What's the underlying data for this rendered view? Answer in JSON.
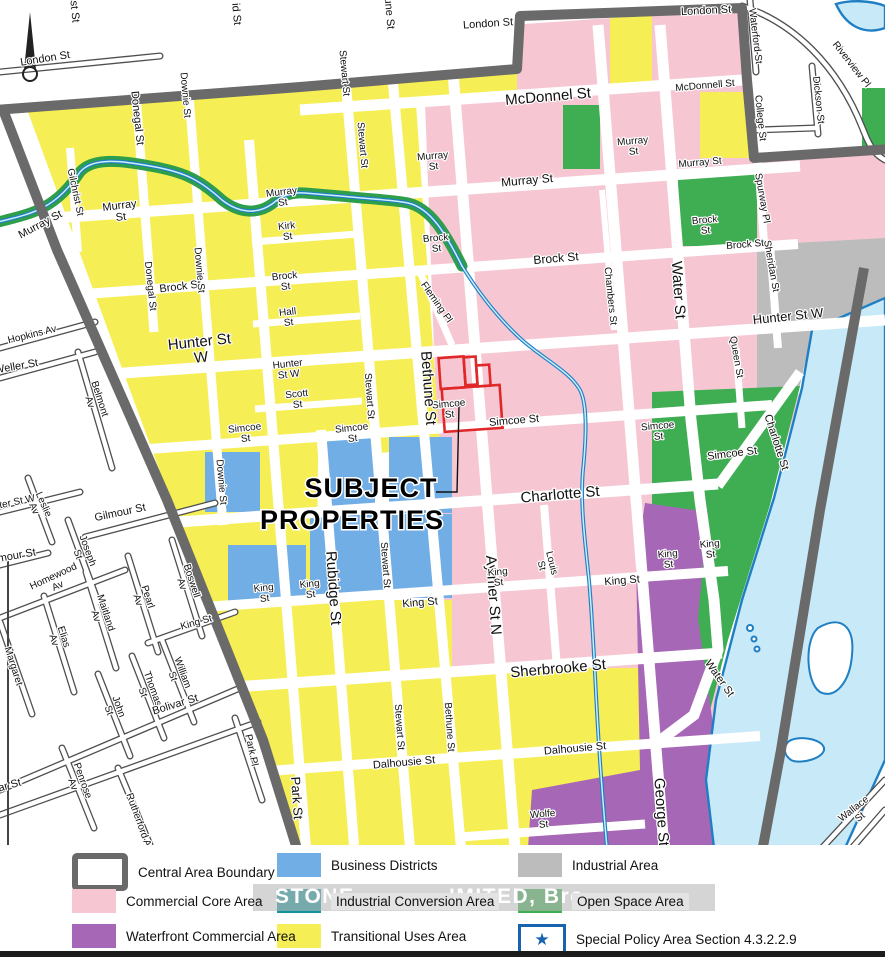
{
  "colors": {
    "pink": "#f6c7d3",
    "purple": "#a667b6",
    "blue": "#72aee6",
    "teal": "#15939a",
    "yellow": "#f6ee55",
    "gray": "#bcbcbc",
    "green": "#3fae53",
    "boundary": "#6a6a6a",
    "river": "#c8e9f7",
    "shore": "#1f7fc4",
    "red": "#e02828",
    "star": "#1763ae",
    "creek_buffer": "#2e9e4a"
  },
  "map": {
    "annotation": {
      "line1": "SUBJECT",
      "line2": "PROPERTIES"
    },
    "watermark": {
      "seg1": "STONE",
      "seg2": "IMITED, Bro"
    },
    "labels": [
      {
        "t": "London St",
        "x": 45,
        "y": 58,
        "r": -9,
        "s": 11
      },
      {
        "t": "Gilchrist St",
        "x": 74,
        "y": -4,
        "r": 85,
        "s": 11
      },
      {
        "t": "id St",
        "x": 237,
        "y": 14,
        "r": 85,
        "s": 11
      },
      {
        "t": "Bethune St",
        "x": 389,
        "y": 2,
        "r": 85,
        "s": 11
      },
      {
        "t": "London St",
        "x": 488,
        "y": 23,
        "r": -4,
        "s": 11
      },
      {
        "t": "London St",
        "x": 706,
        "y": 10,
        "r": -3,
        "s": 11
      },
      {
        "t": "Stewart St",
        "x": 345,
        "y": 73,
        "r": 85,
        "s": 10
      },
      {
        "t": "Stewart St",
        "x": 363,
        "y": 145,
        "r": 85,
        "s": 10
      },
      {
        "t": "Donegal St",
        "x": 138,
        "y": 118,
        "r": 84,
        "s": 11
      },
      {
        "t": "Downie St",
        "x": 186,
        "y": 95,
        "r": 85,
        "s": 10
      },
      {
        "t": "McDonnel St",
        "x": 548,
        "y": 96,
        "r": -5,
        "s": 15
      },
      {
        "t": "McDonnell St",
        "x": 705,
        "y": 85,
        "r": -5,
        "s": 10
      },
      {
        "t": "Murray St",
        "x": 40,
        "y": 224,
        "r": -28,
        "s": 11
      },
      {
        "t": "Murray\nSt",
        "x": 120,
        "y": 210,
        "r": -7,
        "s": 11
      },
      {
        "t": "Murray\nSt",
        "x": 282,
        "y": 196,
        "r": -7,
        "s": 10
      },
      {
        "t": "Gilchrist St",
        "x": 76,
        "y": 192,
        "r": 78,
        "s": 10
      },
      {
        "t": "Murray\nSt",
        "x": 433,
        "y": 160,
        "r": -5,
        "s": 10
      },
      {
        "t": "Murray St",
        "x": 527,
        "y": 180,
        "r": -5,
        "s": 12
      },
      {
        "t": "Murray\nSt",
        "x": 633,
        "y": 145,
        "r": -5,
        "s": 10
      },
      {
        "t": "Murray St",
        "x": 700,
        "y": 162,
        "r": -5,
        "s": 10
      },
      {
        "t": "Kirk\nSt",
        "x": 287,
        "y": 230,
        "r": -6,
        "s": 10
      },
      {
        "t": "Brock St",
        "x": 180,
        "y": 286,
        "r": -7,
        "s": 11
      },
      {
        "t": "Brock\nSt",
        "x": 285,
        "y": 280,
        "r": -6,
        "s": 10
      },
      {
        "t": "Brock\nSt",
        "x": 436,
        "y": 242,
        "r": -5,
        "s": 10
      },
      {
        "t": "Brock St",
        "x": 556,
        "y": 258,
        "r": -5,
        "s": 12
      },
      {
        "t": "Brock\nSt",
        "x": 705,
        "y": 224,
        "r": -5,
        "s": 10
      },
      {
        "t": "Brock St",
        "x": 745,
        "y": 244,
        "r": -5,
        "s": 10
      },
      {
        "t": "Chambers St",
        "x": 611,
        "y": 296,
        "r": 84,
        "s": 10
      },
      {
        "t": "Water St",
        "x": 679,
        "y": 290,
        "r": 86,
        "s": 15
      },
      {
        "t": "Sheridan St",
        "x": 772,
        "y": 266,
        "r": 80,
        "s": 10
      },
      {
        "t": "Spurway Pl",
        "x": 763,
        "y": 198,
        "r": 80,
        "s": 10
      },
      {
        "t": "College St",
        "x": 761,
        "y": 118,
        "r": 84,
        "s": 10
      },
      {
        "t": "Dickson St",
        "x": 819,
        "y": 100,
        "r": 84,
        "s": 10
      },
      {
        "t": "Waterford St",
        "x": 756,
        "y": 36,
        "r": 83,
        "s": 10
      },
      {
        "t": "Riverview Pl",
        "x": 852,
        "y": 64,
        "r": 52,
        "s": 10
      },
      {
        "t": "Hopkins Av",
        "x": 32,
        "y": 334,
        "r": -14,
        "s": 10
      },
      {
        "t": "Weller St",
        "x": 16,
        "y": 366,
        "r": -10,
        "s": 11
      },
      {
        "t": "Belmont\nAv",
        "x": 96,
        "y": 400,
        "r": 72,
        "s": 10
      },
      {
        "t": "Hunter St\nW",
        "x": 200,
        "y": 348,
        "r": -6,
        "s": 15
      },
      {
        "t": "Hunter\nSt W",
        "x": 288,
        "y": 368,
        "r": -6,
        "s": 10
      },
      {
        "t": "Hunter St W",
        "x": 788,
        "y": 316,
        "r": -6,
        "s": 13
      },
      {
        "t": "Hall\nSt",
        "x": 288,
        "y": 316,
        "r": -6,
        "s": 10
      },
      {
        "t": "Scott\nSt",
        "x": 297,
        "y": 398,
        "r": -6,
        "s": 10
      },
      {
        "t": "Fleming Pl",
        "x": 437,
        "y": 302,
        "r": 55,
        "s": 10
      },
      {
        "t": "Hunter St W",
        "x": 8,
        "y": 503,
        "r": -12,
        "s": 10
      },
      {
        "t": "Homewood\nAv",
        "x": 55,
        "y": 580,
        "r": -25,
        "s": 10
      },
      {
        "t": "Simcoe\nSt",
        "x": 245,
        "y": 432,
        "r": -6,
        "s": 10
      },
      {
        "t": "Simcoe\nSt",
        "x": 352,
        "y": 432,
        "r": -6,
        "s": 10
      },
      {
        "t": "Simcoe\nSt",
        "x": 449,
        "y": 408,
        "r": -5,
        "s": 10
      },
      {
        "t": "Simcoe St",
        "x": 514,
        "y": 420,
        "r": -5,
        "s": 11
      },
      {
        "t": "Simcoe\nSt",
        "x": 658,
        "y": 430,
        "r": -5,
        "s": 10
      },
      {
        "t": "Simcoe St",
        "x": 732,
        "y": 453,
        "r": -7,
        "s": 11
      },
      {
        "t": "Queen St",
        "x": 737,
        "y": 357,
        "r": 80,
        "s": 10
      },
      {
        "t": "Charlotte St",
        "x": 560,
        "y": 494,
        "r": -5,
        "s": 15
      },
      {
        "t": "Charlotte St",
        "x": 777,
        "y": 442,
        "r": 72,
        "s": 11
      },
      {
        "t": "Bethune St",
        "x": 429,
        "y": 388,
        "r": 86,
        "s": 15
      },
      {
        "t": "Stewart St",
        "x": 370,
        "y": 396,
        "r": 86,
        "s": 10
      },
      {
        "t": "Downie St",
        "x": 222,
        "y": 482,
        "r": 85,
        "s": 10
      },
      {
        "t": "Downie St",
        "x": 200,
        "y": 270,
        "r": 85,
        "s": 10
      },
      {
        "t": "Donegal St",
        "x": 151,
        "y": 286,
        "r": 84,
        "s": 10
      },
      {
        "t": "Leslie\nAv",
        "x": 40,
        "y": 506,
        "r": 66,
        "s": 10
      },
      {
        "t": "Gilmour St",
        "x": 120,
        "y": 512,
        "r": -12,
        "s": 11
      },
      {
        "t": "Gilmour St",
        "x": 10,
        "y": 556,
        "r": -10,
        "s": 11
      },
      {
        "t": "Joseph\nSt",
        "x": 84,
        "y": 552,
        "r": 70,
        "s": 10
      },
      {
        "t": "Boswell\nAv",
        "x": 188,
        "y": 582,
        "r": 72,
        "s": 10
      },
      {
        "t": "Pearl\nAv",
        "x": 144,
        "y": 598,
        "r": 72,
        "s": 10
      },
      {
        "t": "Maitland\nAv",
        "x": 102,
        "y": 614,
        "r": 72,
        "s": 10
      },
      {
        "t": "Elias\nAv",
        "x": 60,
        "y": 638,
        "r": 72,
        "s": 10
      },
      {
        "t": "Margaret",
        "x": 14,
        "y": 666,
        "r": 72,
        "s": 10
      },
      {
        "t": "Rubidge St",
        "x": 334,
        "y": 588,
        "r": 86,
        "s": 15
      },
      {
        "t": "Stewart St",
        "x": 386,
        "y": 565,
        "r": 86,
        "s": 10
      },
      {
        "t": "Aylmer St N",
        "x": 494,
        "y": 595,
        "r": 86,
        "s": 15
      },
      {
        "t": "Louis\nSt",
        "x": 548,
        "y": 564,
        "r": 76,
        "s": 10
      },
      {
        "t": "King\nSt",
        "x": 264,
        "y": 592,
        "r": -6,
        "s": 10
      },
      {
        "t": "King\nSt",
        "x": 310,
        "y": 588,
        "r": -6,
        "s": 10
      },
      {
        "t": "King St",
        "x": 420,
        "y": 602,
        "r": -5,
        "s": 11
      },
      {
        "t": "King\nSt",
        "x": 498,
        "y": 576,
        "r": -5,
        "s": 10
      },
      {
        "t": "King St",
        "x": 622,
        "y": 580,
        "r": -5,
        "s": 11
      },
      {
        "t": "King\nSt",
        "x": 668,
        "y": 558,
        "r": -5,
        "s": 10
      },
      {
        "t": "King\nSt",
        "x": 710,
        "y": 548,
        "r": -5,
        "s": 10
      },
      {
        "t": "King St",
        "x": 196,
        "y": 622,
        "r": -16,
        "s": 10
      },
      {
        "t": "William\nSt",
        "x": 179,
        "y": 674,
        "r": 70,
        "s": 10
      },
      {
        "t": "Thomas\nSt",
        "x": 149,
        "y": 690,
        "r": 70,
        "s": 10
      },
      {
        "t": "John\nSt",
        "x": 115,
        "y": 708,
        "r": 70,
        "s": 10
      },
      {
        "t": "Bolivar St",
        "x": 175,
        "y": 704,
        "r": -17,
        "s": 11
      },
      {
        "t": "Bolivar St",
        "x": -2,
        "y": 788,
        "r": -16,
        "s": 11
      },
      {
        "t": "Sherbrooke St",
        "x": 558,
        "y": 668,
        "r": -5,
        "s": 15
      },
      {
        "t": "Stewart St",
        "x": 400,
        "y": 727,
        "r": 86,
        "s": 10
      },
      {
        "t": "Bethune St",
        "x": 450,
        "y": 727,
        "r": 86,
        "s": 10
      },
      {
        "t": "George St",
        "x": 662,
        "y": 812,
        "r": 86,
        "s": 15
      },
      {
        "t": "Water St",
        "x": 720,
        "y": 678,
        "r": 55,
        "s": 11
      },
      {
        "t": "Dalhousie St",
        "x": 404,
        "y": 762,
        "r": -5,
        "s": 11
      },
      {
        "t": "Dalhousie St",
        "x": 575,
        "y": 748,
        "r": -5,
        "s": 11
      },
      {
        "t": "Wolfe\nSt",
        "x": 543,
        "y": 818,
        "r": -5,
        "s": 10
      },
      {
        "t": "Park St",
        "x": 297,
        "y": 798,
        "r": 86,
        "s": 13
      },
      {
        "t": "Park Pl",
        "x": 252,
        "y": 750,
        "r": 78,
        "s": 10
      },
      {
        "t": "Penrose\nAv",
        "x": 79,
        "y": 782,
        "r": 70,
        "s": 10
      },
      {
        "t": "Rutherford Av",
        "x": 140,
        "y": 822,
        "r": 70,
        "s": 10
      },
      {
        "t": "Wallace\nSt",
        "x": 856,
        "y": 812,
        "r": -38,
        "s": 10
      }
    ]
  },
  "legend": {
    "items": [
      {
        "label": "Central Area Boundary",
        "swatch": "boundary",
        "bg": false
      },
      {
        "label": "Commercial Core Area",
        "swatch": "pink",
        "bg": false
      },
      {
        "label": "Waterfront Commercial Area",
        "swatch": "purple",
        "bg": false
      },
      {
        "label": "Business Districts",
        "swatch": "blue",
        "bg": false
      },
      {
        "label": "Industrial Conversion Area",
        "swatch": "teal",
        "bg": true
      },
      {
        "label": "Transitional Uses Area",
        "swatch": "yellow",
        "bg": false
      },
      {
        "label": "Industrial Area",
        "swatch": "gray",
        "bg": false
      },
      {
        "label": "Open Space Area",
        "swatch": "green",
        "bg": true
      },
      {
        "label": "Special Policy Area Section 4.3.2.2.9",
        "swatch": "special",
        "bg": false
      }
    ],
    "star_glyph": "★"
  }
}
